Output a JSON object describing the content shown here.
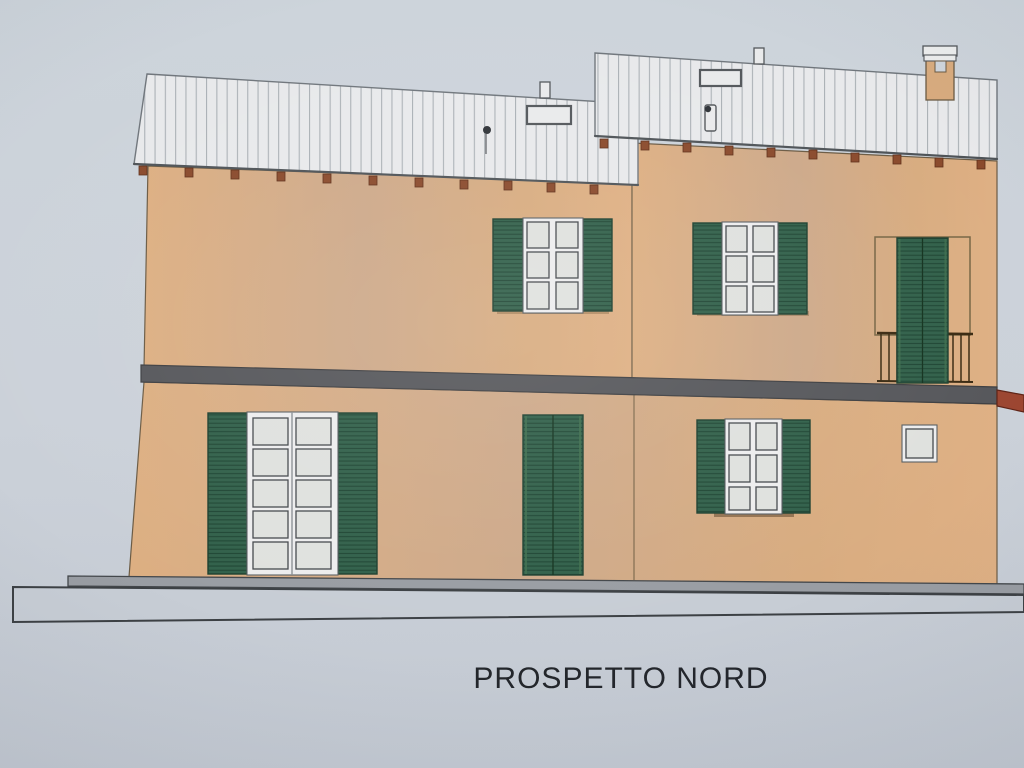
{
  "document": {
    "kind": "architectural-elevation-photo",
    "title": "PROSPETTO NORD"
  },
  "colors": {
    "paper_top": "#cdd4db",
    "paper_mid": "#cbd1d9",
    "paper_bottom": "#c4cad3",
    "wall_a": "#ddaf82",
    "wall_b": "#cda98a",
    "wall_c": "#d8ac80",
    "wall_d": "#dfb084",
    "roof": "#e8e9eb",
    "roof_line": "#abb1b6",
    "shutter": "#31604a",
    "shutter_dark": "#1f4634",
    "frame_white": "#ededee",
    "pane": "#dfe1de",
    "band": "#56575b",
    "red_slab": "#9c4631",
    "rafter": "#8a4a2c",
    "railing": "#3a2a12",
    "base_curb": "#999da3",
    "base_slab": "#c7cdd5",
    "ink": "#23262b"
  },
  "building": {
    "label": "PROSPETTO NORD",
    "floors": 2,
    "roof": {
      "style": "ribbed metal, two offset shed sections",
      "skylights": 2,
      "vent_pipes": 2,
      "stacks": 2,
      "chimneys": 1
    },
    "upper_floor_openings": [
      "double window, open green louvered shutters, 2x3 panes",
      "double window, open green louvered shutters, 2x3 panes",
      "balcony door, closed green louvered shutters, iron railing"
    ],
    "ground_floor_openings": [
      "french door, open green louvered shutters, 2x5 panes",
      "door with closed green louvered shutters",
      "double window, open green louvered shutters, 2x3 panes",
      "small square window"
    ]
  }
}
